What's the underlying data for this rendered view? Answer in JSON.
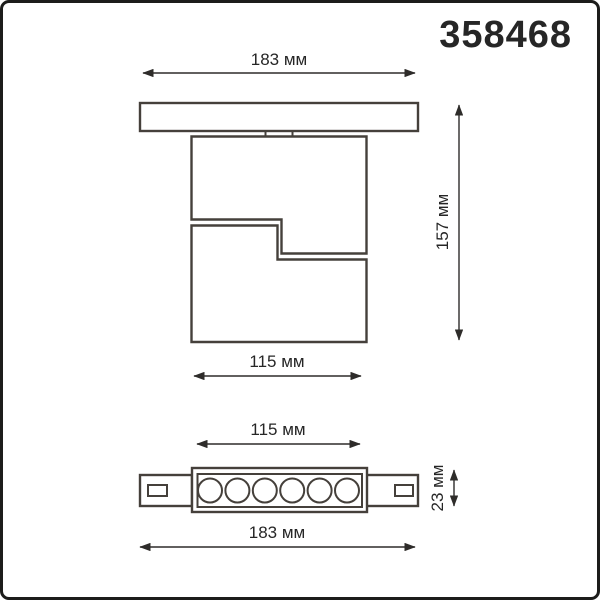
{
  "product_code": "358468",
  "colors": {
    "background": "#ffffff",
    "frame_border": "#1d1d1b",
    "drawing_line": "#45403b",
    "dimension_line": "#2e2c2a",
    "label_text": "#262626"
  },
  "views": {
    "front": {
      "title": "front view - fixture mounted on track",
      "dim_track_width": "183 мм",
      "dim_total_height": "157 мм",
      "dim_body_width": "115 мм"
    },
    "bottom": {
      "title": "bottom view - linear LED module on track",
      "dim_body_width": "115 мм",
      "dim_body_height": "23 мм",
      "dim_track_width": "183 мм",
      "led_count": 6
    }
  }
}
